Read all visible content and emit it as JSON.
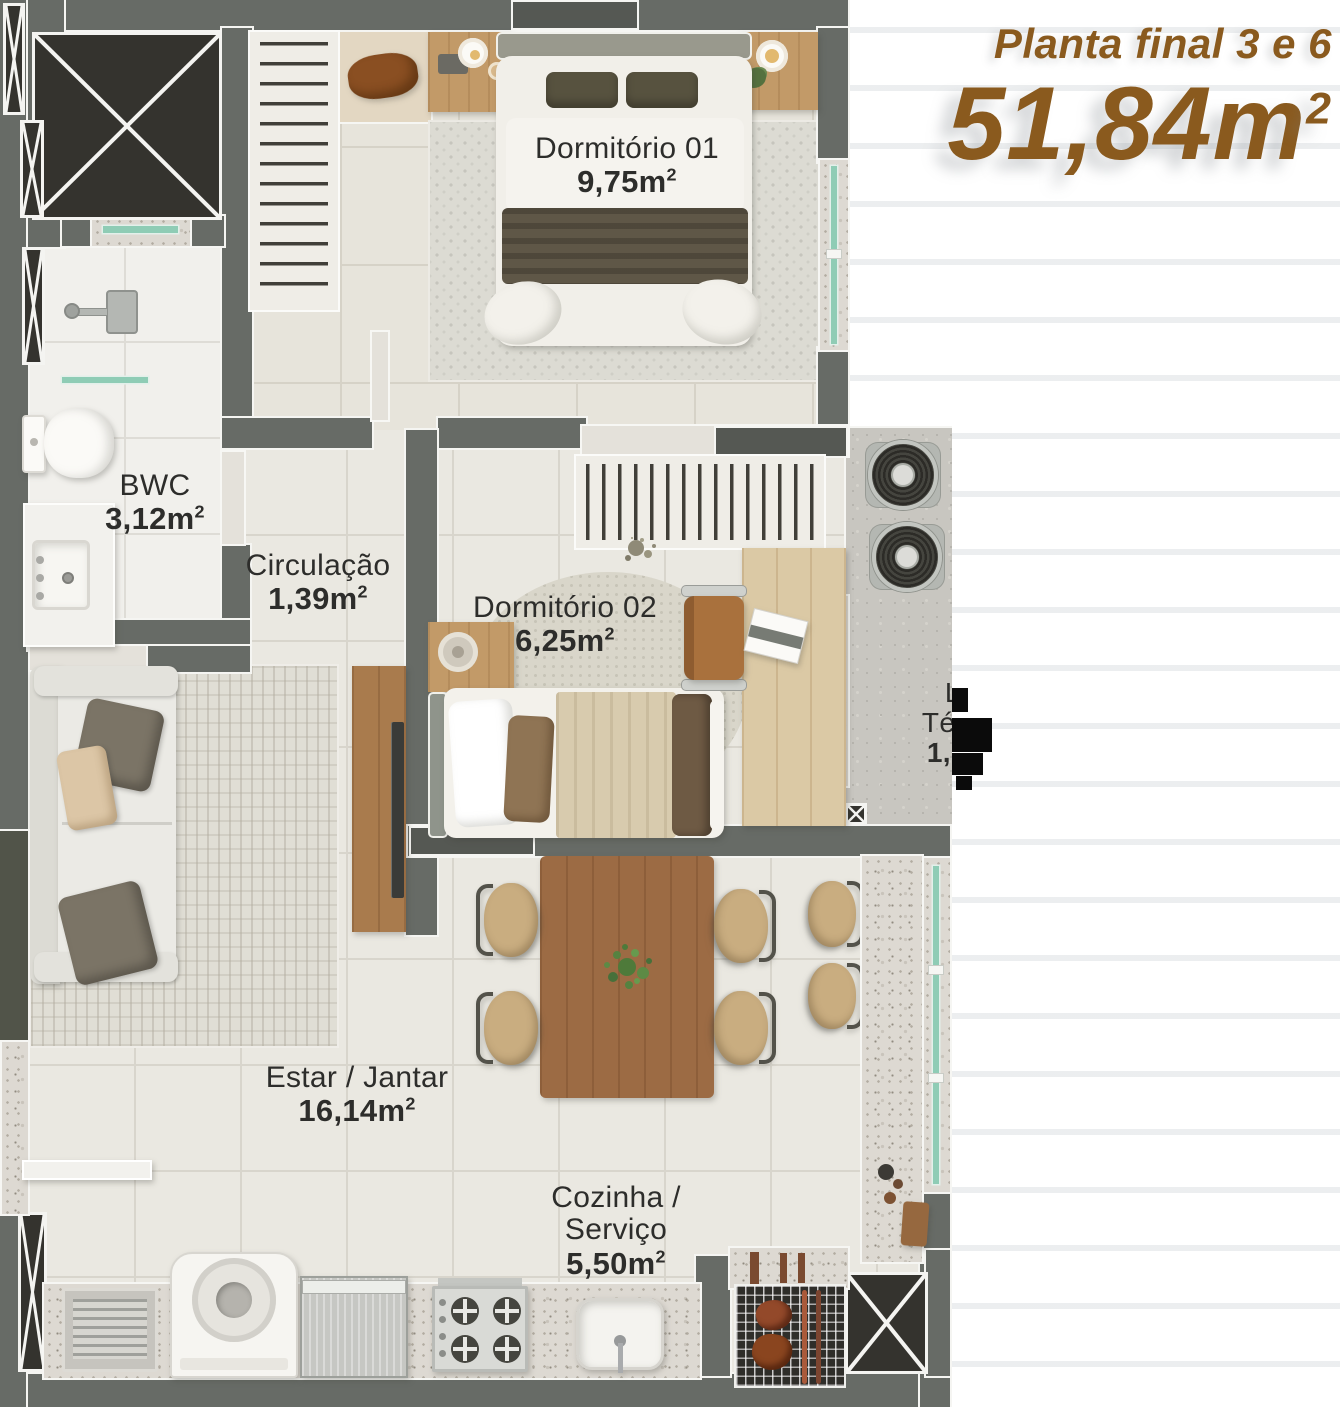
{
  "meta": {
    "sup": "2"
  },
  "title": {
    "line1": "Planta final 3 e 6",
    "area_value": "51,84m"
  },
  "rooms": {
    "dorm1": {
      "name": "Dormitório 01",
      "area": "9,75m"
    },
    "bwc": {
      "name": "BWC",
      "area": "3,12m"
    },
    "circulacao": {
      "name": "Circulação",
      "area": "1,39m"
    },
    "dorm2": {
      "name": "Dormitório 02",
      "area": "6,25m"
    },
    "laje": {
      "line1": "Laje",
      "line2": "Técnica",
      "area": "1,72m"
    },
    "estar": {
      "name": "Estar / Jantar",
      "area": "16,14m"
    },
    "cozinha": {
      "line1": "Cozinha /",
      "line2": "Serviço",
      "area": "5,50m"
    }
  },
  "colors": {
    "title_brown": "#8a5a1e",
    "wall_gray": "#676b66",
    "shaft_dark": "#34332e",
    "glass_teal": "#8fccb5",
    "floor_light": "#eae8e1",
    "wood": "#9c6b44",
    "label_text": "#2d2d2b"
  }
}
